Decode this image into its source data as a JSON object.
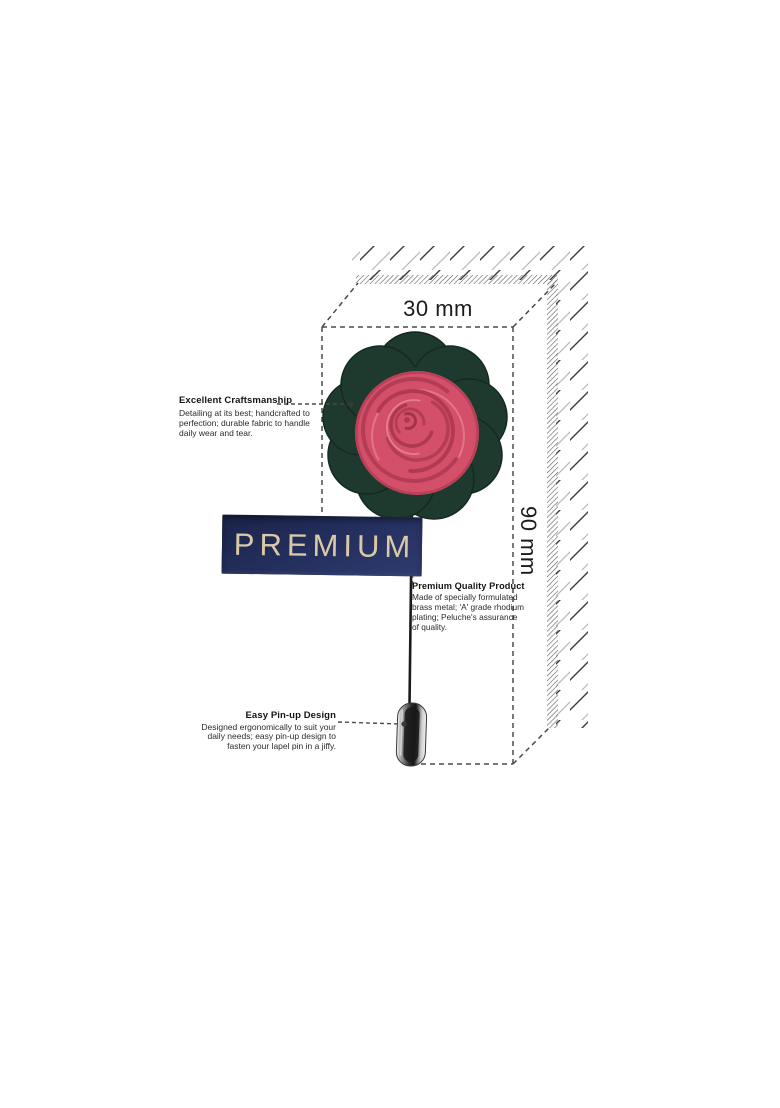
{
  "diagram": {
    "width_label": "30 mm",
    "height_label": "90 mm"
  },
  "banner": {
    "label": "PREMIUM"
  },
  "callouts": {
    "craftsmanship": {
      "title": "Excellent Craftsmanship",
      "body": "Detailing at its best; handcrafted to\nperfection; durable fabric to handle\ndaily wear and tear."
    },
    "quality": {
      "title": "Premium Quality Product",
      "body": "Made of specially formulated\nbrass metal; 'A' grade rhodium\nplating; Peluche's assurance\nof quality."
    },
    "pinup": {
      "title": "Easy Pin-up Design",
      "body": "Designed ergonomically to suit your\ndaily needs; easy pin-up design to\nfasten your lapel pin in a jiffy."
    }
  },
  "colors": {
    "banner_navy": "#232e5c",
    "banner_gold": "#d9c9a6",
    "flower_green": "#1e392d",
    "rose_pink": "#d4506a",
    "line_gray": "#4a4a4a"
  }
}
